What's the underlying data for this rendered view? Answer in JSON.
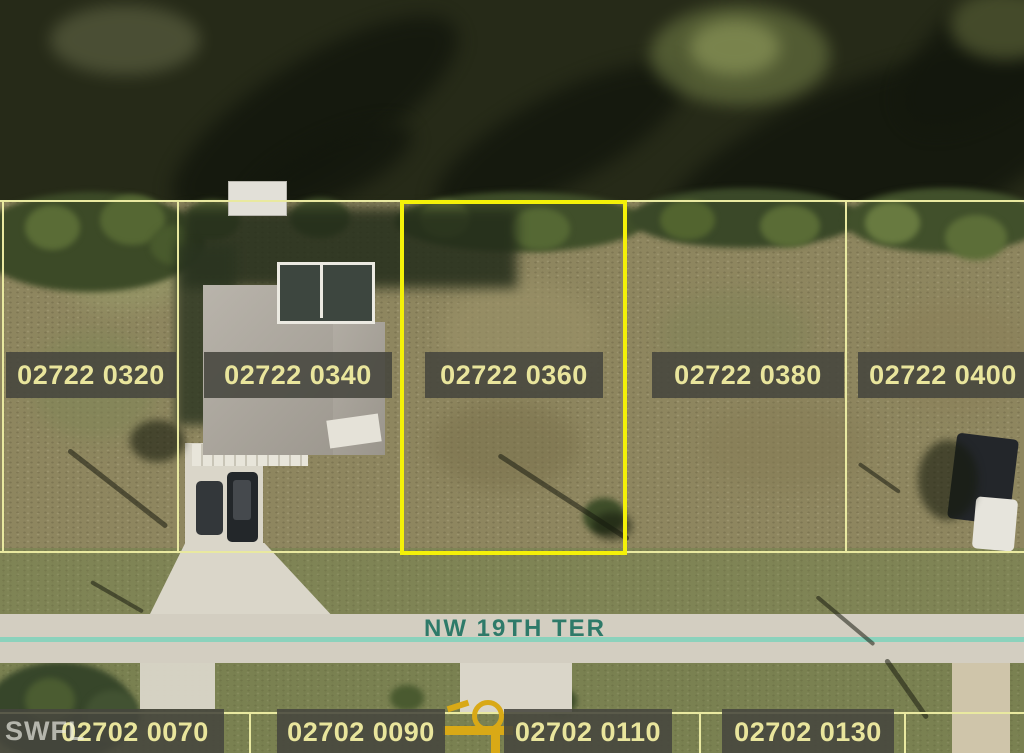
{
  "street": {
    "label": "NW 19TH TER"
  },
  "watermark": "SWFL",
  "selected_parcel_id": "02722 0360",
  "parcels_top": [
    {
      "id": "02722 0320"
    },
    {
      "id": "02722 0340"
    },
    {
      "id": "02722 0360"
    },
    {
      "id": "02722 0380"
    },
    {
      "id": "02722 0400"
    }
  ],
  "parcels_bottom": [
    {
      "id": "02702 0070"
    },
    {
      "id": "02702 0090"
    },
    {
      "id": "02702 0110"
    },
    {
      "id": "02702 0130"
    }
  ],
  "colors": {
    "parcel_line": "#e9e9a0",
    "selected_outline": "#f4f108",
    "label_bg": "rgba(70,70,62,0.88)",
    "label_text": "#e9e59c",
    "street_text": "#2e7a69",
    "road_centerline": "#8bd2bc",
    "marker_yellow": "#d9a916"
  }
}
